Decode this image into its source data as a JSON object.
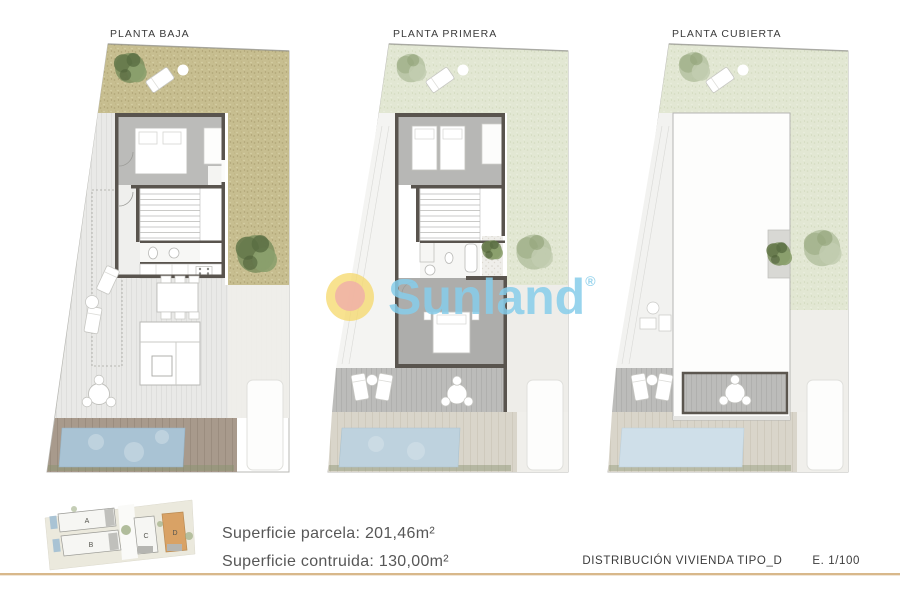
{
  "plans": [
    {
      "title": "PLANTA BAJA"
    },
    {
      "title": "PLANTA PRIMERA"
    },
    {
      "title": "PLANTA CUBIERTA"
    }
  ],
  "watermark": {
    "brand": "Sunland",
    "registered": "®",
    "text_color": "#86cdea",
    "sun_outer_color": "#f6d86a",
    "sun_inner_color": "#f0b0a8"
  },
  "keyplan": {
    "labels": {
      "a": "A",
      "b": "B",
      "c": "C",
      "d": "D"
    },
    "highlight_color": "#d9a265"
  },
  "surface": {
    "line1": "Superficie parcela: 201,46m²",
    "line2": "Superficie contruida: 130,00m²"
  },
  "footer": {
    "title": "DISTRIBUCIÓN VIVIENDA TIPO_D",
    "scale": "E. 1/100",
    "line_color": "#d8b88b"
  },
  "colors": {
    "grass_ground_floor": "#c7be90",
    "grass_upper_floors": "#e2e7d3",
    "terrace": "#e9e9e7",
    "pool_ground": "#a9c3d4",
    "pool_first": "#bed2de",
    "pool_roof": "#cfdfe9",
    "deck_ground": "#a89a8c",
    "deck_upper": "#d9d5ca",
    "wall": "#59544e"
  }
}
